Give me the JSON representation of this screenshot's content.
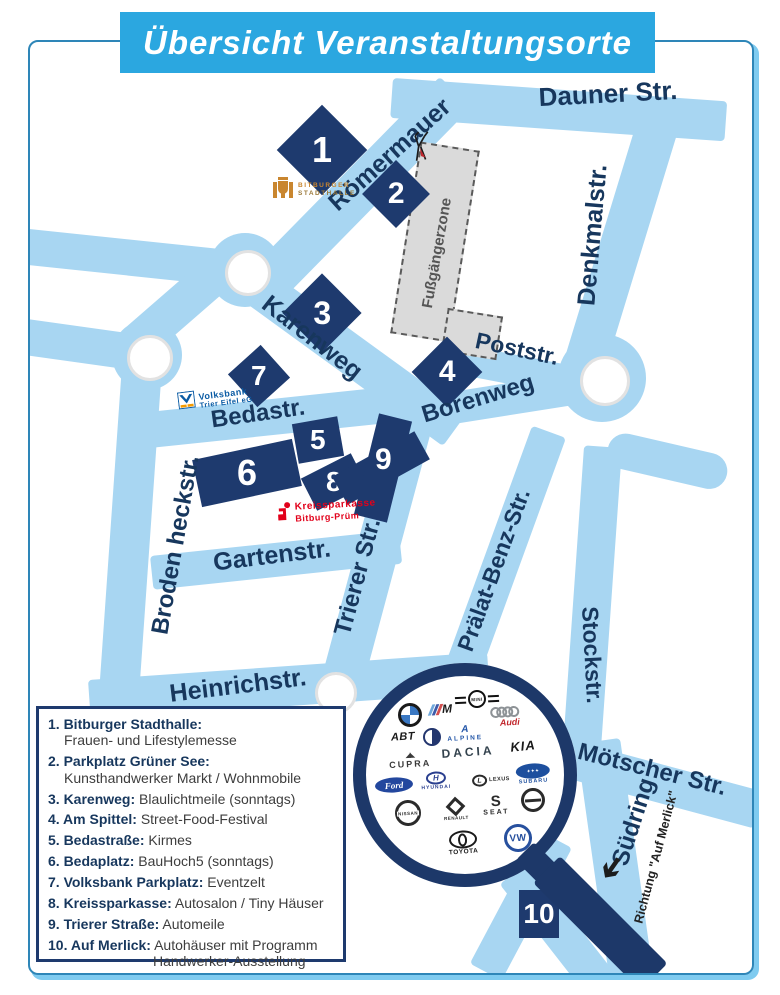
{
  "title": "Übersicht Veranstaltungsorte",
  "streets": {
    "dauner": "Dauner Str.",
    "roemermauer": "Römermauer",
    "denkmalstr": "Denkmalstr.",
    "karenweg": "Karenweg",
    "poststr": "Poststr.",
    "borenweg": "Borenweg",
    "bedastr": "Bedastr.",
    "brodenheckstr": "Broden heckstr.",
    "gartenstr": "Gartenstr.",
    "trierer": "Trierer Str.",
    "praelat": "Prälat-Benz-Str.",
    "stockstr": "Stockstr.",
    "heinrichstr": "Heinrichstr.",
    "moetscher": "Mötscher Str.",
    "suedring": "Südring",
    "fussgaengerzone": "Fußgängerzone",
    "richtung_auf_merlick": "Richtung \"Auf Merlick\""
  },
  "markers": {
    "m1": "1",
    "m2": "2",
    "m3": "3",
    "m4": "4",
    "m5": "5",
    "m6": "6",
    "m7": "7",
    "m8": "8",
    "m9": "9",
    "m10": "10"
  },
  "legend": {
    "items": [
      {
        "label": "1. Bitburger Stadthalle:",
        "desc": "Frauen- und Lifestylemesse"
      },
      {
        "label": "2. Parkplatz Grüner See:",
        "desc": "Kunsthandwerker Markt / Wohnmobile"
      },
      {
        "label": "3. Karenweg:",
        "desc": "Blaulichtmeile (sonntags)"
      },
      {
        "label": "4. Am Spittel:",
        "desc": "Street-Food-Festival"
      },
      {
        "label": "5. Bedastraße:",
        "desc": "Kirmes"
      },
      {
        "label": "6. Bedaplatz:",
        "desc": "BauHoch5 (sonntags)"
      },
      {
        "label": "7. Volksbank Parkplatz:",
        "desc": "Eventzelt"
      },
      {
        "label": "8. Kreissparkasse:",
        "desc": "Autosalon / Tiny Häuser"
      },
      {
        "label": "9. Trierer Straße:",
        "desc": "Automeile"
      },
      {
        "label": "10. Auf Merlick:",
        "desc": "Autohäuser mit Programm",
        "desc2": "Handwerker-Ausstellung"
      }
    ]
  },
  "logos": {
    "stadthalle": {
      "line1": "BITBURGER",
      "line2": "STADTHALLE"
    },
    "volksbank": {
      "line1": "Volksbank",
      "line2": "Trier Eifel eG"
    },
    "kreissparkasse": {
      "line1": "Kreissparkasse",
      "line2": "Bitburg-Prüm"
    }
  },
  "brands": {
    "mini": "MINI",
    "bmw": "BMW",
    "bmw_m": "M",
    "audi": "Audi",
    "abt": "ABT",
    "alpine": "ALPINE",
    "cupra": "CUPRA",
    "dacia": "DACIA",
    "kia": "KIA",
    "ford": "Ford",
    "hyundai": "HYUNDAI",
    "hyundai_h": "H",
    "lexus": "LEXUS",
    "lexus_l": "L",
    "subaru": "SUBARU",
    "nissan": "NISSAN",
    "renault": "RENAULT",
    "seat": "SEAT",
    "seat_s": "S",
    "toyota": "TOYOTA",
    "vw": "VW"
  },
  "colors": {
    "street": "#A8D6F2",
    "marker_navy": "#1E3A6E",
    "banner_blue": "#2BA7E0",
    "label_navy": "#17375D",
    "sparkasse_red": "#E2001A",
    "volksbank_blue": "#0A5BA4",
    "stadthalle_orange": "#C9862F"
  }
}
